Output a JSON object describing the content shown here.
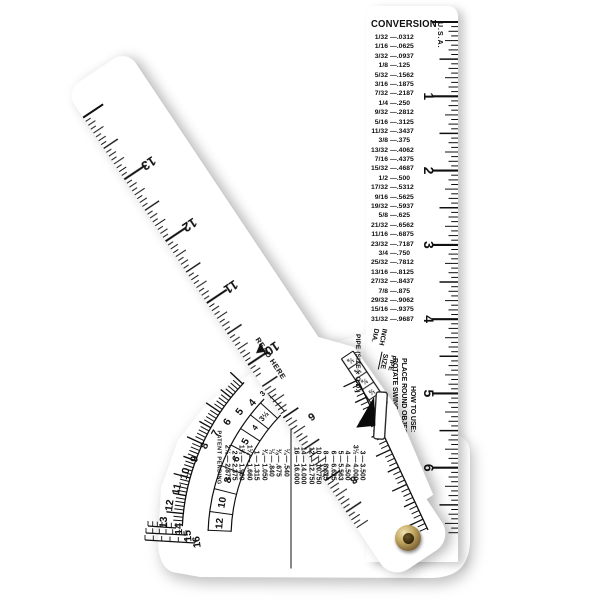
{
  "main_ruler": {
    "title": "CONVERSION",
    "country": "U.S.A.",
    "conversion_chart": [
      [
        "1/32",
        ".0312"
      ],
      [
        "1/16",
        ".0625"
      ],
      [
        "3/32",
        ".0937"
      ],
      [
        "1/8",
        ".125"
      ],
      [
        "5/32",
        ".1562"
      ],
      [
        "3/16",
        ".1875"
      ],
      [
        "7/32",
        ".2187"
      ],
      [
        "1/4",
        ".250"
      ],
      [
        "9/32",
        ".2812"
      ],
      [
        "5/16",
        ".3125"
      ],
      [
        "11/32",
        ".3437"
      ],
      [
        "3/8",
        ".375"
      ],
      [
        "13/32",
        ".4062"
      ],
      [
        "7/16",
        ".4375"
      ],
      [
        "15/32",
        ".4687"
      ],
      [
        "1/2",
        ".500"
      ],
      [
        "17/32",
        ".5312"
      ],
      [
        "9/16",
        ".5625"
      ],
      [
        "19/32",
        ".5937"
      ],
      [
        "5/8",
        ".625"
      ],
      [
        "21/32",
        ".6562"
      ],
      [
        "11/16",
        ".6875"
      ],
      [
        "23/32",
        ".7187"
      ],
      [
        "3/4",
        ".750"
      ],
      [
        "25/32",
        ".7812"
      ],
      [
        "13/16",
        ".8125"
      ],
      [
        "27/32",
        ".8437"
      ],
      [
        "7/8",
        ".875"
      ],
      [
        "29/32",
        ".9062"
      ],
      [
        "15/16",
        ".9375"
      ],
      [
        "31/32",
        ".9687"
      ]
    ],
    "inch_labels": [
      "1",
      "2",
      "3",
      "4",
      "5",
      "6",
      "7"
    ],
    "how_to_use": [
      "HOW TO USE:",
      "PLACE ROUND OBJECT IN COR",
      "ROTATE SWING ARM AGAI"
    ]
  },
  "swing_arm": {
    "inch_labels": [
      "13",
      "12",
      "11",
      "10"
    ],
    "diameter_labels": [
      "6",
      "8"
    ],
    "fraction_labels": [
      "⅛",
      "¼",
      "⅜",
      "½"
    ],
    "read_here": "READ HERE"
  },
  "gauge": {
    "inch_dia_label": [
      "INCH",
      "DIA."
    ],
    "pipe_size_label": [
      "PIPE",
      "SIZE"
    ],
    "outer_scale": [
      "4",
      "5",
      "6",
      "7",
      "8",
      "9",
      "10",
      "11",
      "12",
      "13",
      "14",
      "15",
      "16"
    ],
    "pipe_scale": [
      "3",
      "3½",
      "4",
      "5",
      "6",
      "8",
      "10",
      "12"
    ],
    "table_header": "PIPE (SIZE x O.D.)",
    "pipe_table_large": [
      [
        "3",
        "3.500"
      ],
      [
        "3½",
        "4.000"
      ],
      [
        "4",
        "4.500"
      ],
      [
        "5",
        "5.563"
      ],
      [
        "6",
        "6.625"
      ],
      [
        "8",
        "8.625"
      ],
      [
        "10",
        "10.750"
      ],
      [
        "12",
        "12.750"
      ],
      [
        "14",
        "14.000"
      ],
      [
        "16",
        "16.000"
      ]
    ],
    "pipe_table_small": [
      [
        "¼",
        ".540"
      ],
      [
        "⅜",
        ".675"
      ],
      [
        "½",
        ".840"
      ],
      [
        "¾",
        "1.050"
      ],
      [
        "1",
        "1.315"
      ],
      [
        "1¼",
        "1.660"
      ],
      [
        "1½",
        "1.900"
      ],
      [
        "2",
        "2.375"
      ],
      [
        "2½",
        "2.875"
      ]
    ],
    "patent": "PATENT PENDING"
  },
  "colors": {
    "print": "#101010",
    "plastic": "#ffffff",
    "rivet_outer": "#8a6f3f",
    "rivet_dark": "#2a2008"
  }
}
